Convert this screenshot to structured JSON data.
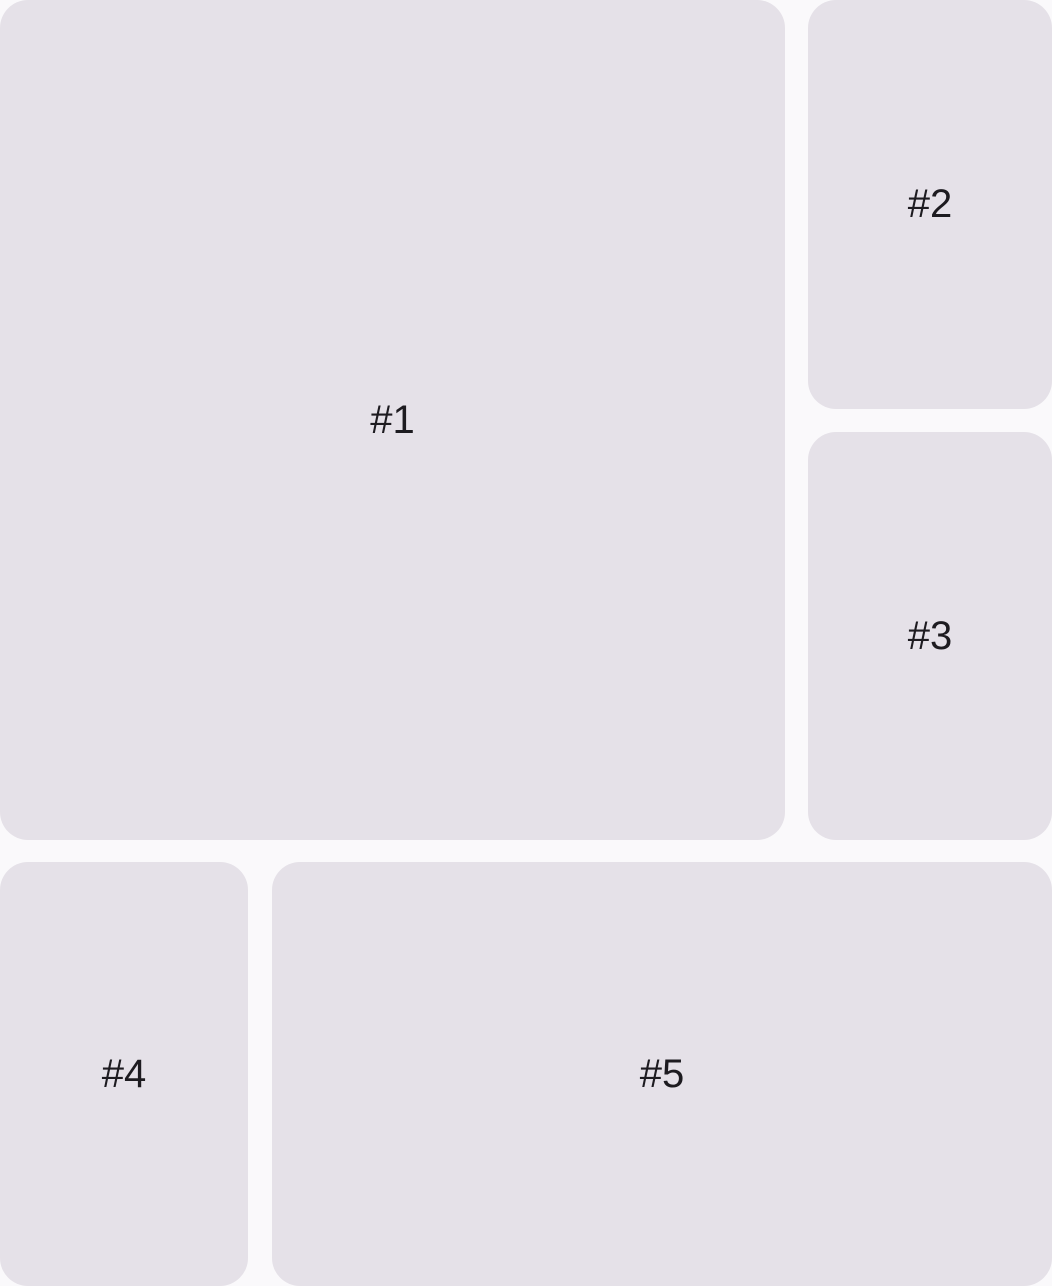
{
  "theme": {
    "background_color": "#faf9fb",
    "panel_color": "#e5e1e8",
    "text_color": "#1d1b20"
  },
  "panels": [
    {
      "label": "#1"
    },
    {
      "label": "#2"
    },
    {
      "label": "#3"
    },
    {
      "label": "#4"
    },
    {
      "label": "#5"
    }
  ]
}
